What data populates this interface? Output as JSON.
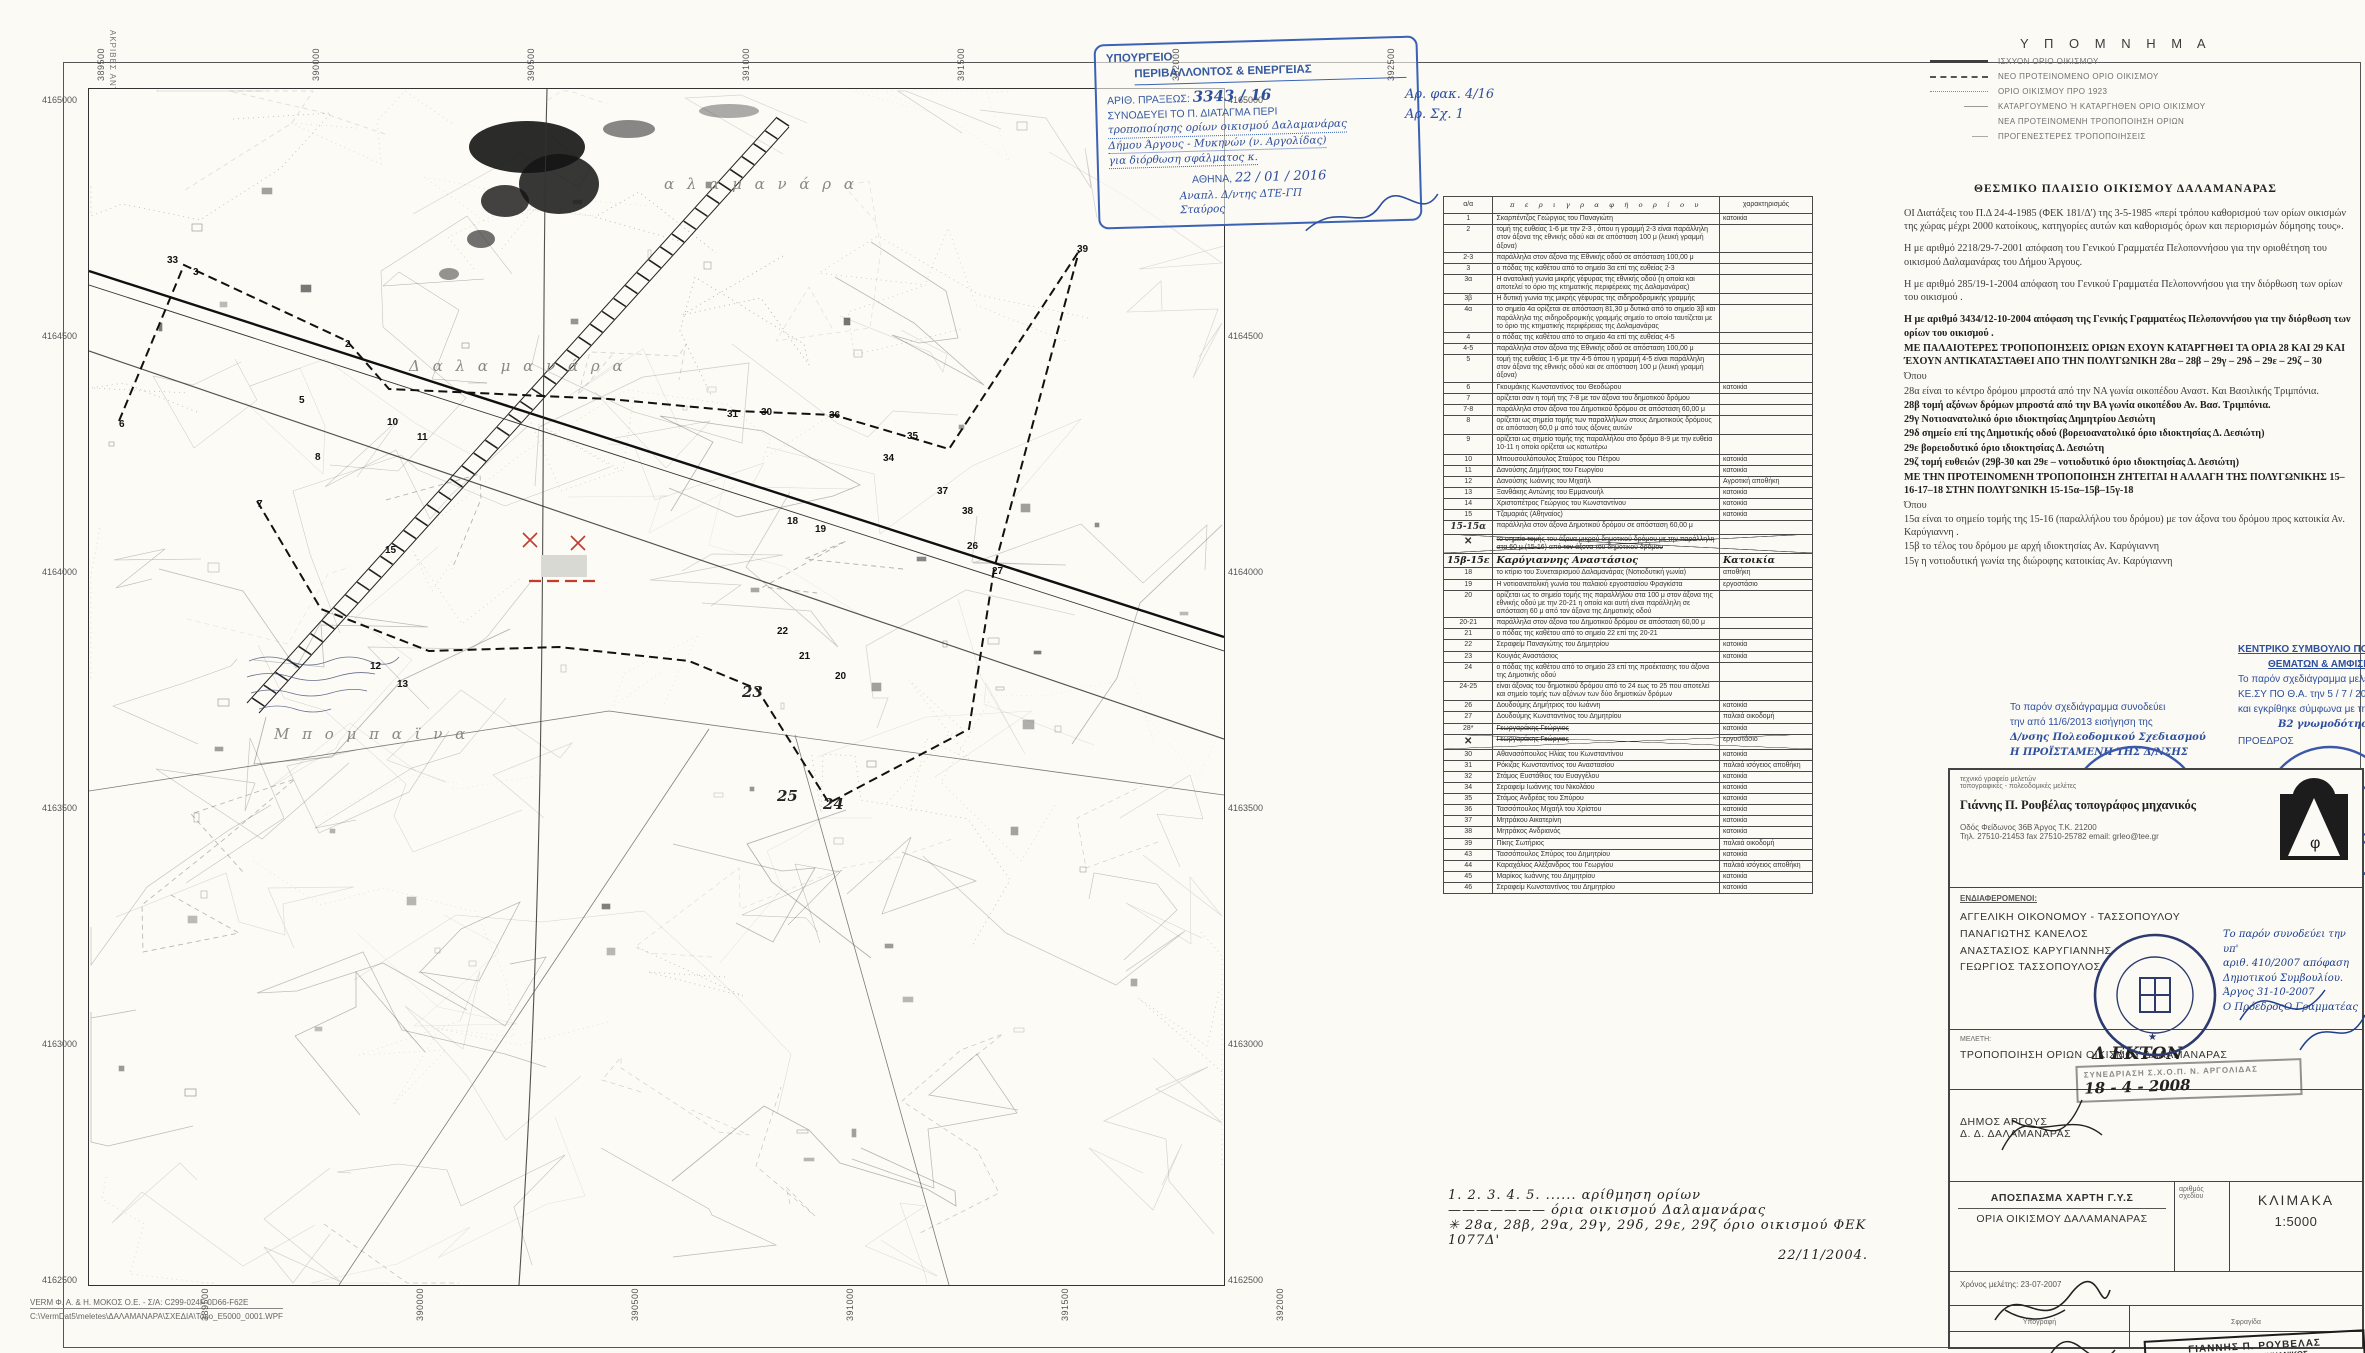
{
  "copy_note": "ΑΚΡΙΒΕΣ ΑΝΤΙΓΡΑΦΟ  ΜΑΓΔΑΛΗΝΗ ΜΠΕΛΕ",
  "footer": {
    "line1": "VERM Φ. Α. & Η. ΜΟΚΟΣ  Ο.Ε. - Σ/Α: C299-024F-0D66-F62E",
    "line2": "C:\\VermDat5\\meletes\\ΔΑΛΑΜΑΝΑΡΑ\\ΣΧΕΔΙΑ\\Topo_E5000_0001.WPF"
  },
  "map": {
    "top_coords": [
      "389500",
      "390000",
      "390500",
      "391000",
      "391500",
      "392000",
      "392500"
    ],
    "bottom_coords": [
      "389500",
      "390000",
      "390500",
      "391000",
      "391500",
      "392000"
    ],
    "side_coords": [
      "4165000",
      "4164500",
      "4164000",
      "4163500",
      "4163000",
      "4162500"
    ],
    "labels": [
      {
        "t": "α λ α μ α ν ά ρ α",
        "x": 575,
        "y": 86,
        "cls": "place"
      },
      {
        "t": "Δ α λ α μ α ν ά ρ α",
        "x": 320,
        "y": 268,
        "cls": "place"
      },
      {
        "t": "Μ π ο μ π α ϊ ν α",
        "x": 185,
        "y": 636,
        "cls": "place"
      },
      {
        "t": "25",
        "x": 688,
        "y": 698,
        "cls": "mhand"
      },
      {
        "t": "24",
        "x": 734,
        "y": 706,
        "cls": "mhand"
      },
      {
        "t": "23",
        "x": 653,
        "y": 594,
        "cls": "mhand"
      }
    ],
    "points": [
      {
        "t": "33",
        "x": 78,
        "y": 166
      },
      {
        "t": "3",
        "x": 104,
        "y": 178
      },
      {
        "t": "2",
        "x": 256,
        "y": 250
      },
      {
        "t": "5",
        "x": 210,
        "y": 306
      },
      {
        "t": "6",
        "x": 30,
        "y": 330
      },
      {
        "t": "7",
        "x": 168,
        "y": 410
      },
      {
        "t": "8",
        "x": 226,
        "y": 363
      },
      {
        "t": "10",
        "x": 298,
        "y": 328
      },
      {
        "t": "11",
        "x": 328,
        "y": 343
      },
      {
        "t": "12",
        "x": 281,
        "y": 572
      },
      {
        "t": "13",
        "x": 308,
        "y": 590
      },
      {
        "t": "15",
        "x": 296,
        "y": 456
      },
      {
        "t": "31",
        "x": 638,
        "y": 320
      },
      {
        "t": "30",
        "x": 672,
        "y": 318
      },
      {
        "t": "36",
        "x": 740,
        "y": 321
      },
      {
        "t": "35",
        "x": 818,
        "y": 342
      },
      {
        "t": "34",
        "x": 794,
        "y": 364
      },
      {
        "t": "37",
        "x": 848,
        "y": 397
      },
      {
        "t": "38",
        "x": 873,
        "y": 417
      },
      {
        "t": "39",
        "x": 988,
        "y": 155
      },
      {
        "t": "27",
        "x": 903,
        "y": 477
      },
      {
        "t": "26",
        "x": 878,
        "y": 452
      },
      {
        "t": "18",
        "x": 698,
        "y": 427
      },
      {
        "t": "19",
        "x": 726,
        "y": 435
      },
      {
        "t": "22",
        "x": 688,
        "y": 537
      },
      {
        "t": "21",
        "x": 710,
        "y": 562
      },
      {
        "t": "20",
        "x": 746,
        "y": 582
      }
    ]
  },
  "ministry_stamp": {
    "l1": "ΥΠΟΥΡΓΕΙΟ",
    "l2": "ΠΕΡΙΒΑΛΛΟΝΤΟΣ & ΕΝΕΡΓΕΙΑΣ",
    "l3a": "ΑΡΙΘ. ΠΡΑΞΕΩΣ:",
    "l3b": "3343 / 16",
    "l4": "ΣΥΝΟΔΕΥΕΙ ΤΟ Π. ΔΙΑΤΑΓΜΑ ΠΕΡΙ",
    "hand1": "τροποποίησης ορίων οικισμού Δαλαμανάρας",
    "hand2": "Δήμου Άργους - Μυκηνών (ν. Αργολίδας)",
    "hand3": "για διόρθωση σφάλματος κ.",
    "l5a": "ΑΘΗΝΑ,",
    "l5b": "22 / 01 / 2016",
    "hand4": "Αναπλ. Δ/ντης ΔΤΕ-ΓΠ",
    "hand5": "Σταύρος"
  },
  "side_note": {
    "l1": "Αρ. φακ. 4/16",
    "l2": "Αρ. Σχ. 1"
  },
  "table": {
    "headers": {
      "num": "α/α",
      "desc": "π ε ρ ι γ ρ α φ ή   ο ρ ί ο υ",
      "char": "χαρακτηρισμός"
    },
    "rows": [
      [
        "1",
        "Σκαρπέντζος Γεώργιος του Παναγιώτη",
        "κατοικία",
        ""
      ],
      [
        "2",
        "τομή της ευθείας 1-6 με την 2-3 , όπου η γραμμή 2-3 είναι παράλληλη στον άξονα της εθνικής οδού και σε απόσταση 100 μ (λευκή γραμμή άξονα)",
        "",
        ""
      ],
      [
        "2-3",
        "παράλληλα στον άξονα της Εθνικής οδού σε απόσταση 100,00 μ",
        "",
        ""
      ],
      [
        "3",
        "ο πόδας της καθέτου από το σημείο 3α επί της ευθείας 2-3",
        "",
        ""
      ],
      [
        "3α",
        "Η ανατολική γωνία μικρής γέφυρας της εθνικής οδού (η οποία και αποτελεί το όριο της κτηματικής περιφέρειας της Δαλαμανάρας)",
        "",
        ""
      ],
      [
        "3β",
        "Η δυτική γωνία της μικρής γέφυρας της σιδηροδρομικής γραμμής",
        "",
        ""
      ],
      [
        "4α",
        "το σημείο 4α ορίζεται σε απόσταση 81,30 μ δυτικά από το σημείο 3β και παράλληλα της σιδηροδρομικής γραμμής σημείο το οποίο ταυτίζεται με το όριο της κτηματικής περιφέρειας της Δαλαμανάρας",
        "",
        ""
      ],
      [
        "4",
        "ο πόδας της καθέτου από το σημείο 4α επί της ευθείας 4-5",
        "",
        ""
      ],
      [
        "4-5",
        "παράλληλα στον άξονα της Εθνικής οδού σε απόσταση 100,00 μ",
        "",
        ""
      ],
      [
        "5",
        "τομή της ευθείας 1-6 με την 4-5 όπου η γραμμή 4-5 είναι παράλληλη στον άξονα της εθνικής οδού και σε απόσταση 100 μ (λευκή γραμμή άξονα)",
        "",
        ""
      ],
      [
        "6",
        "Γκουμάκης Κωνσταντίνος του Θεοδώρου",
        "κατοικία",
        ""
      ],
      [
        "7",
        "ορίζεται σαν η τομή της 7-8 με τον άξονα του δημοτικού δρόμου",
        "",
        ""
      ],
      [
        "7-8",
        "παράλληλα στον άξονα του Δημοτικού δρόμου σε απόσταση 60,00 μ",
        "",
        ""
      ],
      [
        "8",
        "ορίζεται ως σημεία τομής των παραλλήλων στους Δημοτικούς δρόμους σε απόσταση 60,0 μ από τους άξονες αυτών",
        "",
        ""
      ],
      [
        "9",
        "ορίζεται ως σημείο τομής της παραλλήλου στο δρόμο 8-9 με την ευθεία 10-11 η οποία ορίζεται ως κατωτέρω",
        "",
        ""
      ],
      [
        "10",
        "Μπουσουλόπουλος Σταύρος του Πέτρου",
        "κατοικία",
        ""
      ],
      [
        "11",
        "Δανούσης Δημήτριος του Γεωργίου",
        "κατοικία",
        ""
      ],
      [
        "12",
        "Δανούσης Ιωάννης του Μιχαήλ",
        "Αγροτική αποθήκη",
        ""
      ],
      [
        "13",
        "Ξανθάκης Αντώνης του Εμμανουήλ",
        "κατοικία",
        ""
      ],
      [
        "14",
        "Χριστοπέτρος Γεώργιος του Κωνσταντίνου",
        "κατοικία",
        ""
      ],
      [
        "15",
        "Τζαμαριάς (Αθηναίος)",
        "κατοικία",
        ""
      ],
      [
        "15-15α",
        "παράλληλα στον άξονα Δημοτικού δρόμου σε απόσταση 60,00 μ",
        "",
        "numhand"
      ],
      [
        "✕",
        "το σημείο τομής του άξονα μικρού δημοτικού δρόμου με την παράλληλη στα 60 μ (15-16) από τον άξονα του δημοτικού δρόμου",
        "",
        "x numx strike"
      ],
      [
        "15β-15ε",
        "Καρύγιαννης Αναστάσιος",
        "Κατοικία",
        "hand"
      ],
      [
        "18",
        "το κτίριο του Συνεταιρισμού Δαλαμανάρας (Νοτιοδυτική γωνία)",
        "αποθήκη",
        ""
      ],
      [
        "19",
        "Η νοτιοανατολική γωνία του παλαιού εργοστασίου Φραγκίστα",
        "εργοστάσιο",
        ""
      ],
      [
        "20",
        "ορίζεται ως το σημείο τομής της παραλλήλου στα 100 μ στον άξονα της εθνικής οδού με την 20-21 η οποία και αυτή είναι παράλληλη σε απόσταση 60 μ από τον άξονα της Δημοτικής οδού",
        "",
        ""
      ],
      [
        "20-21",
        "παράλληλα στον άξονα του Δημοτικού δρόμου σε απόσταση 60,00 μ",
        "",
        ""
      ],
      [
        "21",
        "ο πόδας της καθέτου από το σημείο 22 επί της 20-21",
        "",
        ""
      ],
      [
        "22",
        "Σεραφείμ Παναγιώτης του Δημητρίου",
        "κατοικία",
        ""
      ],
      [
        "23",
        "Κουγιάς Αναστάσιος",
        "κατοικία",
        ""
      ],
      [
        "24",
        "ο πόδας της καθέτου από το σημείο 23 επί της προέκτασης του άξονα της Δημοτικής οδού",
        "",
        ""
      ],
      [
        "24-25",
        "είναι άξονας του δημοτικού δρόμου από το 24 εως το 25 που αποτελεί και σημείο τομής των αξόνων των δύο δημοτικών δρόμων",
        "",
        ""
      ],
      [
        "26",
        "Δουδούμης Δημήτριος του Ιωάννη",
        "κατοικία",
        ""
      ],
      [
        "27",
        "Δουδούμης Κωνσταντίνος του Δημητρίου",
        "παλαιά οικοδομή",
        ""
      ],
      [
        "28*",
        "Γεωργαράκης Γεώργιος",
        "κατοικία",
        "strike"
      ],
      [
        "✕",
        "Γεωργαράκης Γεώργιος",
        "εργοστάσιο",
        "x numx strike"
      ],
      [
        "30",
        "Αθανασόπουλος Ηλίας του Κωνσταντίνου",
        "κατοικία",
        ""
      ],
      [
        "31",
        "Ρόκιζας Κωνσταντίνος του Αναστασίου",
        "παλαιά ισόγειος αποθήκη",
        ""
      ],
      [
        "32",
        "Στάμος Ευστάθιος του Ευαγγέλου",
        "κατοικία",
        ""
      ],
      [
        "34",
        "Σεραφείμ Ιωάννης του Νικολάου",
        "κατοικία",
        ""
      ],
      [
        "35",
        "Στάμος Ανδρέας του Σπύρου",
        "κατοικία",
        ""
      ],
      [
        "36",
        "Τασσόπουλος Μιχαήλ του Χρίστου",
        "κατοικία",
        ""
      ],
      [
        "37",
        "Μητράκου Αικατερίνη",
        "κατοικία",
        ""
      ],
      [
        "38",
        "Μητράκος Ανδριανός",
        "κατοικία",
        ""
      ],
      [
        "39",
        "Πίκης Σωτήριος",
        "παλαιά οικοδομή",
        ""
      ],
      [
        "43",
        "Τασσόπουλος Σπύρος του Δημητρίου",
        "κατοικία",
        ""
      ],
      [
        "44",
        "Καραχάλιος Αλέξανδρος του Γεωργίου",
        "παλαιά ισόγειος αποθήκη",
        ""
      ],
      [
        "45",
        "Μαρίκος Ιωάννης του Δημητρίου",
        "κατοικία",
        ""
      ],
      [
        "46",
        "Σεραφείμ Κωνσταντίνος του Δημητρίου",
        "κατοικία",
        ""
      ]
    ],
    "notes": [
      "1. 2. 3. 4. 5. ......      αρίθμηση  ορίων",
      "———————            όρια  οικισμού  Δαλαμανάρας",
      "✳ 28α, 28β, 29α, 29γ, 29δ, 29ε, 29ζ   όριο οικισμού ΦΕΚ 1077Δ'",
      "22/11/2004."
    ]
  },
  "legend": {
    "title": "Υ Π Ο Μ Ν Η Μ Α",
    "items": [
      {
        "label": "ΙΣΧΥΟΝ ΟΡΙΟ ΟΙΚΙΣΜΟΥ",
        "style": "sw-solid"
      },
      {
        "label": "ΝΕΟ ΠΡΟΤΕΙΝΟΜΕΝΟ ΟΡΙΟ ΟΙΚΙΣΜΟΥ",
        "style": "sw-dash"
      },
      {
        "label": "ΟΡΙΟ ΟΙΚΙΣΜΟΥ ΠΡΟ 1923",
        "style": "sw-dot"
      },
      {
        "label": "ΚΑΤΑΡΓΟΥΜΕΝΟ Ή ΚΑΤΑΡΓΗΘΕΝ ΟΡΙΟ ΟΙΚΙΣΜΟΥ",
        "style": "sw-short"
      },
      {
        "label": "ΝΕΑ ΠΡΟΤΕΙΝΟΜΕΝΗ ΤΡΟΠΟΠΟΙΗΣΗ ΟΡΙΩΝ",
        "style": "sw-blank"
      },
      {
        "label": "ΠΡΟΓΕΝΕΣΤΕΡΕΣ ΤΡΟΠΟΠΟΙΗΣΕΙΣ",
        "style": "sw-tick"
      }
    ]
  },
  "framework": {
    "title": "ΘΕΣΜΙΚΟ ΠΛΑΙΣΙΟ ΟΙΚΙΣΜΟΥ ΔΑΛΑΜΑΝΑΡΑΣ",
    "paragraphs": [
      {
        "text": "ΟΙ Διατάξεις του Π.Δ 24-4-1985 (ΦΕΚ 181/Δ') της 3-5-1985 «περί τρόπου καθορισμού των ορίων οικισμών της χώρας μέχρι 2000 κατοίκους, κατηγορίες αυτών και καθορισμός όρων και περιορισμών δόμησης τους».",
        "bold": false
      },
      {
        "text": "Η με αριθμό 2218/29-7-2001 απόφαση του Γενικού Γραμματέα Πελοποννήσου για την οριοθέτηση του οικισμού Δαλαμανάρας του Δήμου Άργους.",
        "bold": false
      },
      {
        "text": "Η με αριθμό 285/19-1-2004 απόφαση του Γενικού Γραμματέα Πελοποννήσου  για την διόρθωση των ορίων του οικισμού .",
        "bold": false
      },
      {
        "text": "Η με αριθμό 3434/12-10-2004 απόφαση της Γενικής Γραμματέως Πελοποννήσου για την διόρθωση των ορίων του οικισμού .",
        "bold": true
      },
      {
        "text": "ΜΕ ΠΑΛΑΙΟΤΕΡΕΣ ΤΡΟΠΟΠΟΙΗΣΕΙΣ ΟΡΙΩΝ ΕΧΟΥΝ ΚΑΤΑΡΓΗΘΕΙ ΤΑ ΟΡΙΑ 28 ΚΑΙ 29 ΚΑΙ ΈΧΟΥΝ ΑΝΤΙΚΑΤΑΣΤΑΘΕΙ ΑΠΟ ΤΗΝ ΠΟΛΥΓΩΝΙΚΗ 28α – 28β – 29γ – 29δ – 29ε – 29ζ – 30",
        "bold": true
      },
      {
        "text": "Όπου",
        "bold": false,
        "tight": true
      },
      {
        "text": "28α  είναι το κέντρο δρόμου μπροστά από την ΝΑ γωνία οικοπέδου Αναστ. Και Βασιλικής Τριμπόνια.",
        "bold": false,
        "tight": true
      },
      {
        "text": "28β τομή αξόνων δρόμων μπροστά από την ΒΑ γωνία οικοπέδου Αν. Βασ. Τριμπόνια.",
        "bold": true,
        "tight": true
      },
      {
        "text": "29γ Νοτιοανατολικό όριο ιδιοκτησίας Δημητρίου Δεσιώτη",
        "bold": true,
        "tight": true
      },
      {
        "text": "29δ σημείο επί της Δημοτικής οδού (βορειοανατολικό όριο ιδιοκτησίας Δ. Δεσιώτη)",
        "bold": true,
        "tight": true
      },
      {
        "text": "29ε  βορειοδυτικό όριο ιδιοκτησίας Δ. Δεσιώτη",
        "bold": true,
        "tight": true
      },
      {
        "text": "29ζ τομή ευθειών (29β-30 και 29ε – νοτιοδυτικό όριο ιδιοκτησίας Δ. Δεσιώτη)",
        "bold": true
      },
      {
        "text": "ΜΕ ΤΗΝ ΠΡΟΤΕΙΝΟΜΕΝΗ ΤΡΟΠΟΠΟΙΗΣΗ ΖΗΤΕΙΤΑΙ Η ΑΛΛΑΓΗ ΤΗΣ ΠΟΛΥΓΩΝΙΚΗΣ 15–16-17–18 ΣΤΗΝ ΠΟΛΥΓΩΝΙΚΗ 15-15α–15β–15γ-18",
        "bold": true,
        "tight": true
      },
      {
        "text": "Όπου",
        "bold": false,
        "tight": true
      },
      {
        "text": "15α είναι το σημείο τομής  της 15-16 (παραλλήλου του δρόμου) με τον άξονα του δρόμου προς κατοικία Αν. Καρύγιαννη .",
        "bold": false,
        "tight": true
      },
      {
        "text": "15β το τέλος του δρόμου με αρχή ιδιοκτησίας Αν. Καρύγιαννη",
        "bold": false,
        "tight": true
      },
      {
        "text": "15γ η  νοτιοδυτική γωνία της διώροφης κατοικίας Αν. Καρύγιαννη",
        "bold": false
      }
    ]
  },
  "dir_stamp": {
    "l1": "Το παρόν σχεδιάγραμμα συνοδεύει",
    "l2": "την από 11/6/2013 εισήγηση της",
    "l3": "Δ/νσης Πολεοδομικού Σχεδιασμού",
    "l4": "Η ΠΡΟΪΣΤΑΜΕΝΗ ΤΗΣ Δ/ΝΣΗΣ",
    "sig": "Α. ΚΟΥΔΟΥΝΗ"
  },
  "kesy_stamp": {
    "t1": "ΚΕΝΤΡΙΚΟ ΣΥΜΒΟΥΛΙΟ ΠΟΛΕΟΔΟΜΙΚΩΝ",
    "t2": "ΘΕΜΑΤΩΝ & ΑΜΦΙΣΒΗΤΗΣΕΩΝ",
    "l1": "Το παρόν σχεδιάγραμμα μελετήθηκε από το",
    "l2": "ΚΕ.ΣΥ ΠΟ Θ.Α.  την  5 / 7 / 2013",
    "l3": "και εγκρίθηκε σύμφωνα με την υπ' αριθμ",
    "l4": "Β2  γνωμοδότησή του",
    "role1": "ΠΡΟΕΔΡΟΣ",
    "role2": "ΓΡΑΜΜΑΤΕΑΣ",
    "sig1": "Σ. ΑΛΕΞΙΑΔΟΥ",
    "sig2": "Χ. ΚΑΣΑΠΗ"
  },
  "title_block": {
    "office1": "τεχνικό γραφείο μελετών",
    "office2": "τοπογραφικές - πολεοδομικές μελέτες",
    "name": "Γιάννης Π. Ρουβέλας τοπογράφος μηχανικός",
    "addr1": "Οδός Φείδωνος 36Β   Άργος   Τ.Κ. 21200",
    "addr2": "Τηλ. 27510-21453  fax 27510-25782  email: grleo@tee.gr",
    "interested_hdr": "ΕΝΔΙΑΦΕΡΟΜΕΝΟΙ:",
    "interested": [
      "ΑΓΓΕΛΙΚΗ ΟΙΚΟΝΟΜΟΥ - ΤΑΣΣΟΠΟΥΛΟΥ",
      "ΠΑΝΑΓΙΩΤΗΣ ΚΑΝΕΛΟΣ",
      "ΑΝΑΣΤΑΣΙΟΣ ΚΑΡΥΓΙΑΝΝΗΣ",
      "ΓΕΩΡΓΙΟΣ ΤΑΣΣΟΠΟΥΛΟΣ"
    ],
    "council1": "Το παρόν συνοδεύει την υπ'",
    "council2": "αριθ. 410/2007 απόφαση",
    "council3": "Δημοτικού Συμβουλίου.",
    "council4": "Άργος 31-10-2007",
    "council5": "Ο Πρόεδρος",
    "council6": "Ο Γραμματέας",
    "meleti_hdr": "ΜΕΛΕΤΗ:",
    "meleti": "ΤΡΟΠΟΠΟΙΗΣΗ ΟΡΙΩΝ ΟΙΚΙΣΜΟΥ ΔΑΛΑΜΑΝΑΡΑΣ",
    "dekton": "Δ ΕΚΤΟΝ",
    "schop_stamp": "ΣΥΝΕΔΡΙΑΣΗ  Σ.Χ.Ο.Π.  Ν.  ΑΡΓΟΛΙΔΑΣ",
    "schop_date": "18 - 4 - 2008",
    "dimos1": "ΔΗΜΟΣ ΑΡΓΟΥΣ",
    "dimos2": "Δ. Δ. ΔΑΛΑΜΑΝΑΡΑΣ",
    "apospasma1": "ΑΠΟΣΠΑΣΜΑ ΧΑΡΤΗ Γ.Υ.Σ",
    "apospasma2": "ΟΡΙΑ ΟΙΚΙΣΜΟΥ ΔΑΛΑΜΑΝΑΡΑΣ",
    "sheet_no_label1": "αριθμός",
    "sheet_no_label2": "σχεδίου",
    "klimaka_label": "ΚΛΙΜΑΚΑ",
    "klimaka": "1:5000",
    "xronos": "Χρόνος μελέτης:   23-07-2007",
    "ypografi": "Υπογραφή",
    "sfragida": "Σφραγίδα",
    "stamp1": "ΓΙΑΝΝΗΣ  Π.  ΡΟΥΒΕΛΑΣ",
    "stamp2": "ΤΟΠΟΓΡΑΦΟΣ   ΜΗΧΑΝΙΚΟΣ",
    "stamp3": "Πάρ. Φείδωνος 36β - ΑΡΓΟΣ",
    "stamp4": "Τηλ. 0751 - 21453 - 25782  Fax 21453",
    "stamp5": "α.φ.μ.  21364017   ΔΟΥ  ΑΡΓΟΥΣ"
  },
  "colors": {
    "stamp_blue": "#3a62b5",
    "seal_blue": "#3c58a8",
    "red_mark": "#c23b2e",
    "ink": "#2b2b2b"
  }
}
